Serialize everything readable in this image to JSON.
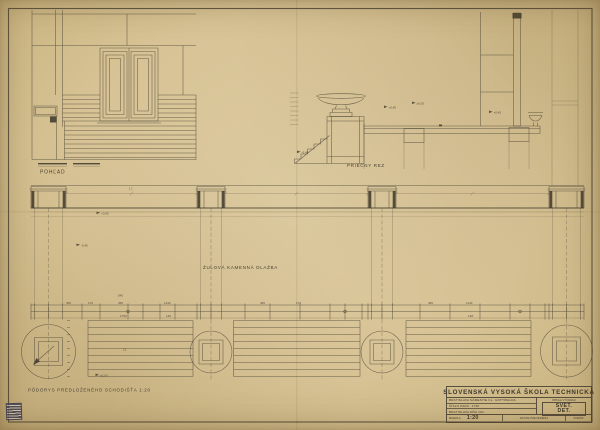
{
  "colors": {
    "paper": "#d7c395",
    "ink": "#4a4334",
    "stamp": "#6b6878"
  },
  "labels": {
    "elevation": "POHĽAD",
    "section": "PRIEČNY REZ",
    "paving": "ŽULOVÁ KAMENNÁ DLAŽBA",
    "plan": "PÔDORYS PREDLOŽENÉHO SCHODIŠŤA 1:20"
  },
  "section_levels": [
    {
      "text": "-0,45"
    },
    {
      "text": "+0,45"
    },
    {
      "text": "±0,00"
    },
    {
      "text": "+0,45"
    }
  ],
  "plan_levels": [
    {
      "text": "+0,05"
    },
    {
      "text": "-0,45"
    },
    {
      "text": "±0,00"
    }
  ],
  "plan_dims": [
    "450",
    "170",
    "540",
    "450",
    "1143",
    "1750",
    "140",
    "450",
    "170",
    "450",
    "1143",
    "148"
  ],
  "plan_note": "12",
  "title_block": {
    "school": "SLOVENSKÁ VYSOKÁ ŠKOLA TECHNICKÁ",
    "address": "BRATISLAVA NÁMESTIE KL. GOTTWALDA",
    "parcel": "ČÍSLO PARC. 1738",
    "place_date": "BRATISLAVA DŇA 194",
    "scale_label": "MIERKA",
    "scale_value": "1:20",
    "content_label": "OBSAH VÝKRESU",
    "content_line1": "SVET.",
    "content_line2": "DET.",
    "footer_mid": "DATUM PREVEDENIA",
    "footer_right": "PODPIS"
  }
}
